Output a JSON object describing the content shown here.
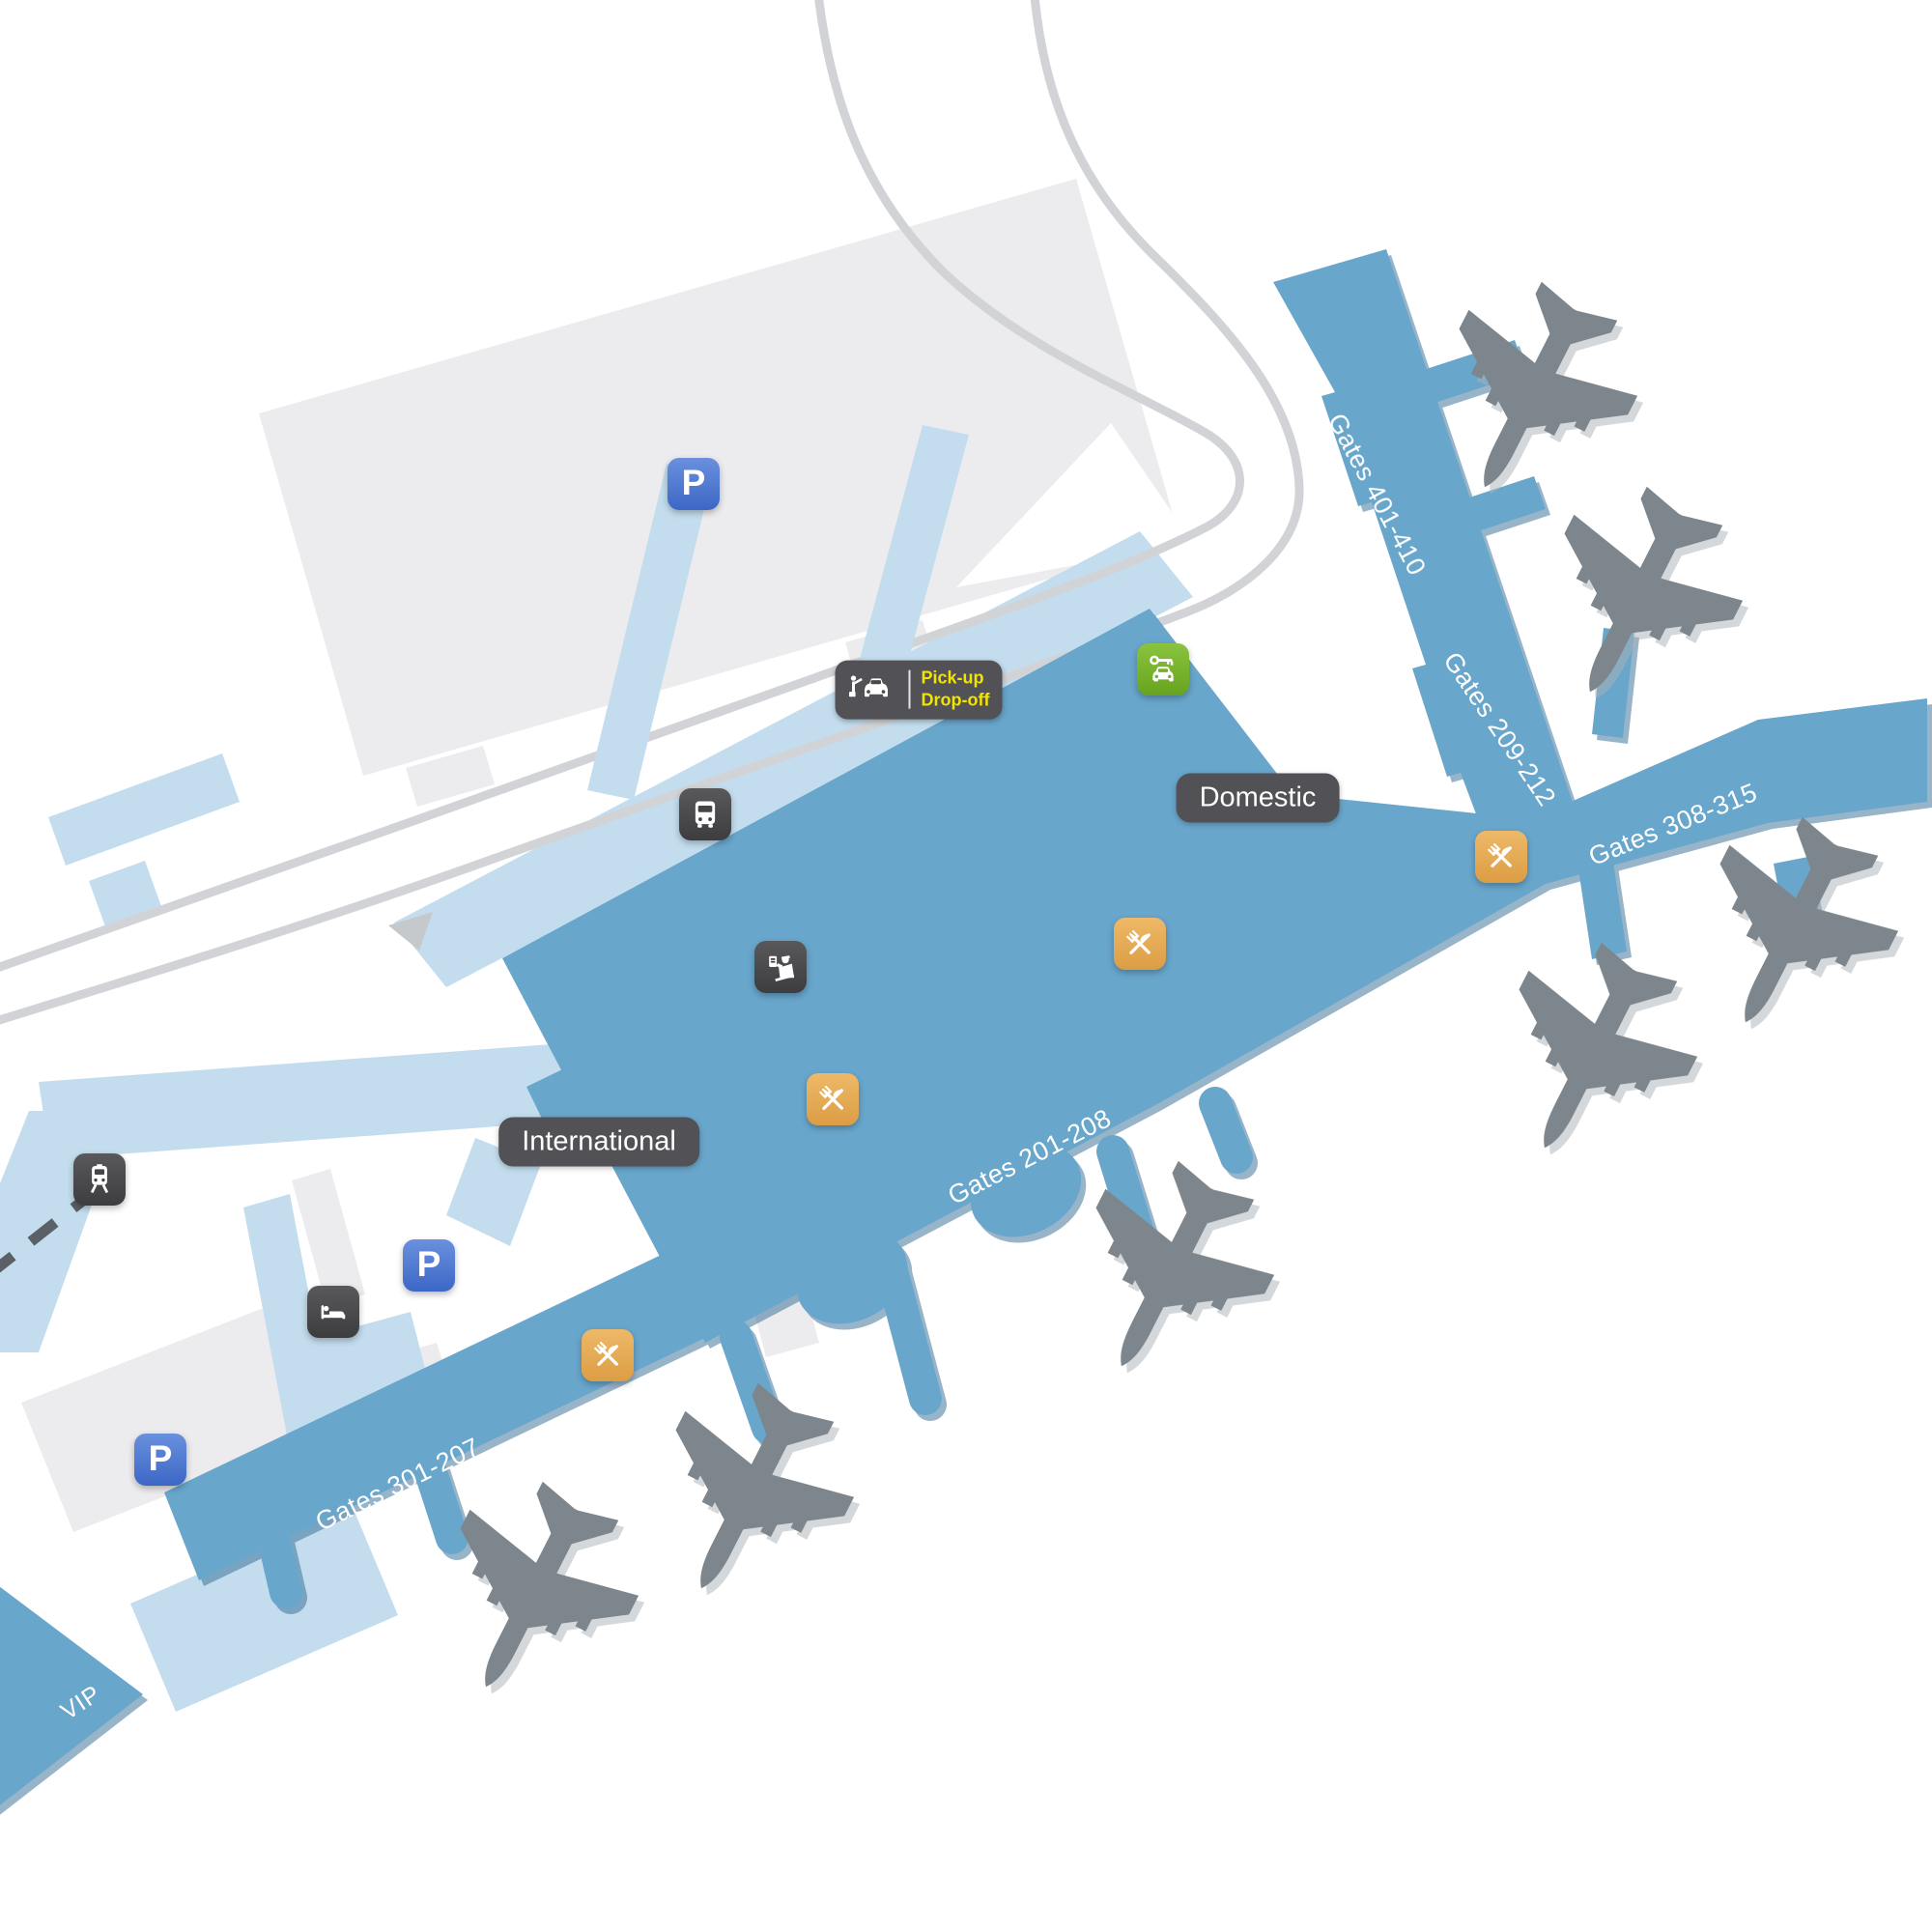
{
  "page": {
    "title": "Airport terminal map"
  },
  "areas": {
    "domestic": "Domestic",
    "international": "International",
    "vip": "VIP"
  },
  "gates": {
    "g401_410": "Gates 401-410",
    "g209_212": "Gates 209-212",
    "g308_315": "Gates 308-315",
    "g201_208": "Gates 201-208",
    "g301_207": "Gates 301-207"
  },
  "transport": {
    "pickup_line1": "Pick-up",
    "pickup_line2": "Drop-off",
    "parking_letter": "P"
  },
  "icons": {
    "parking": "parking-sign",
    "bus": "bus-stop",
    "train": "train-station",
    "hotel": "hotel-bed",
    "passport": "passport-control",
    "restaurant": "fork-and-knife",
    "car_rental": "car-rental-key",
    "taxi": "taxi-pickup"
  },
  "colors": {
    "terminal": "#69a6cc",
    "apron": "#c3ddee",
    "building": "#ececee",
    "road": "#d2d3d6",
    "rail": "#5a6065",
    "plane": "#7d868c",
    "pill": "#515156",
    "pickup_text": "#f2e300",
    "restaurant": "#e7ab59",
    "rental_green": "#76b82a",
    "parking_blue": "#4a76ce",
    "icon_dark": "#474749"
  }
}
